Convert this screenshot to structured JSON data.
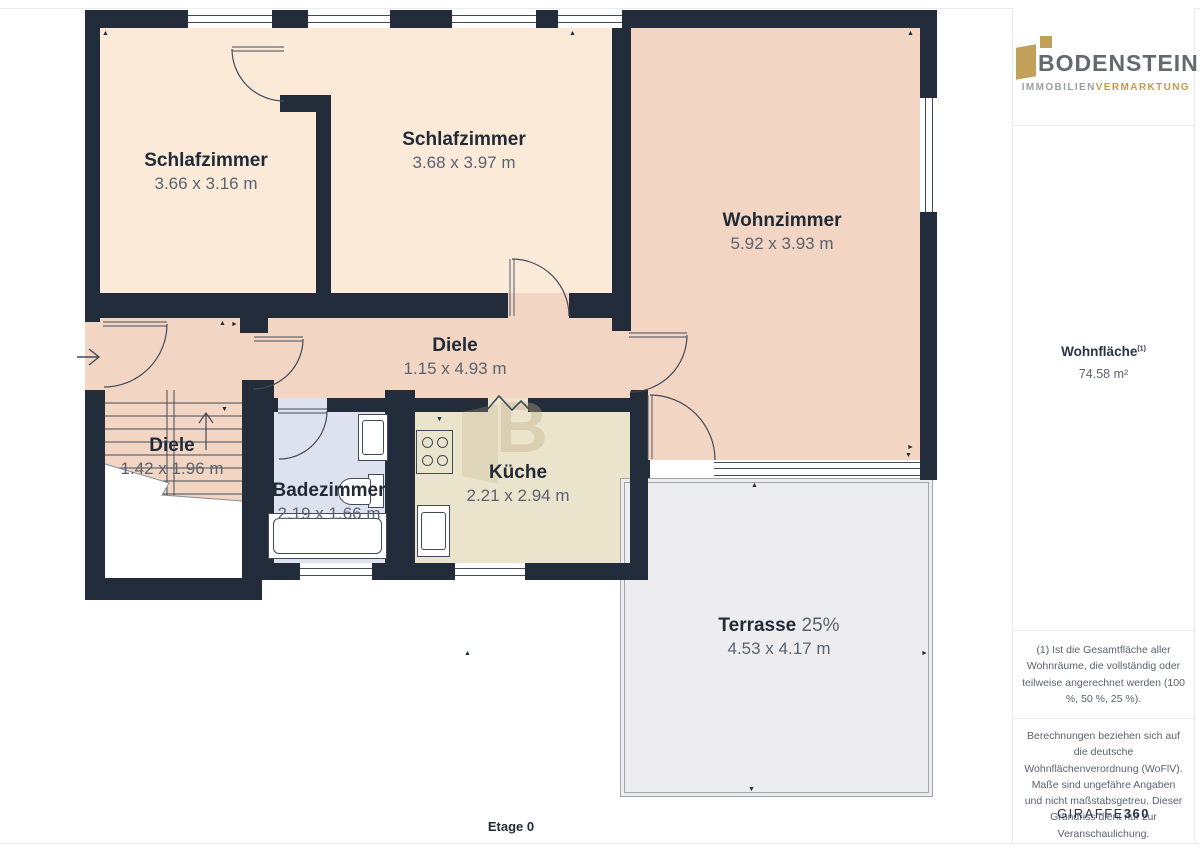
{
  "page": {
    "floor_label": "Etage 0"
  },
  "colors": {
    "wall": "#222c3a",
    "linework": "#424b5a",
    "bedroom_fill": "#fcead9",
    "living_and_hall_fill": "#f2d5c3",
    "bath_fill": "#dee2ee",
    "kitchen_fill": "#ebe4cd",
    "terrace_fill": "#ededef",
    "terrace_border": "#a0a5ac",
    "label_dark": "#212b38",
    "label_gray": "#5b6370",
    "brand_gold": "#c09e56",
    "brand_gray": "#64696e",
    "brand_sub_gray": "#9aa0a5",
    "divider": "#e9ebee"
  },
  "icons": {
    "arrow_up": "▲",
    "arrow_down": "▼",
    "arrow_left": "◄",
    "arrow_right": "►",
    "watermark_letter": "B"
  },
  "rooms": [
    {
      "id": "schlafzimmer-1",
      "name": "Schlafzimmer",
      "dims": "3.66 x 3.16 m"
    },
    {
      "id": "schlafzimmer-2",
      "name": "Schlafzimmer",
      "dims": "3.68 x 3.97 m"
    },
    {
      "id": "wohnzimmer",
      "name": "Wohnzimmer",
      "dims": "5.92 x 3.93 m"
    },
    {
      "id": "diele",
      "name": "Diele",
      "dims": "1.15 x 4.93 m"
    },
    {
      "id": "diele-treppe",
      "name": "Diele",
      "dims": "1.42 x 1.96 m"
    },
    {
      "id": "badezimmer",
      "name": "Badezimmer",
      "dims": "2.19 x 1.66 m"
    },
    {
      "id": "kueche",
      "name": "Küche",
      "dims": "2.21 x 2.94 m"
    },
    {
      "id": "terrasse",
      "name": "Terrasse",
      "share": "25%",
      "dims": "4.53 x 4.17 m"
    }
  ],
  "sidebar": {
    "logo": {
      "brand": "BODENSTEIN",
      "sub_left": "IMMOBILIEN",
      "sub_right": "VERMARKTUNG"
    },
    "area": {
      "label": "Wohnfläche",
      "footnote_marker": "(1)",
      "value": "74.58 m²"
    },
    "footnote": "(1) Ist die Gesamtfläche aller Wohnräume, die vollständig oder teilweise angerechnet werden (100 %, 50 %, 25 %).",
    "disclaimer": "Berechnungen beziehen sich auf die deutsche Wohnflächenverordnung (WoFlV). Maße sind ungefähre Angaben und nicht maßstabsgetreu. Dieser Grundriss dient nur zur Veranschaulichung.",
    "brand_footer": {
      "name": "GIRAFFE",
      "suffix": "360"
    }
  }
}
